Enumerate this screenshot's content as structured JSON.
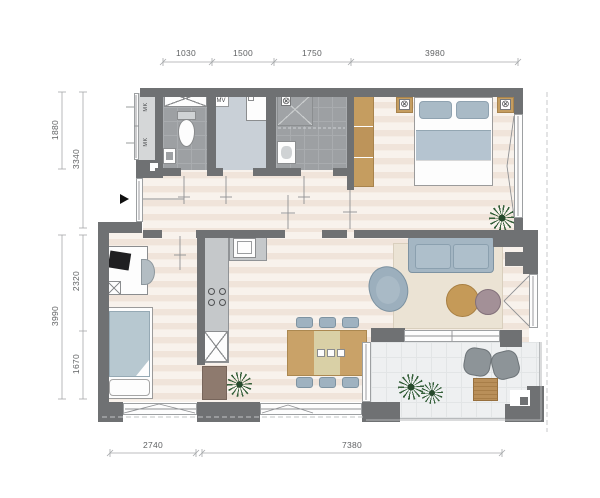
{
  "dimensions": {
    "top": [
      "1030",
      "1500",
      "1750",
      "3980"
    ],
    "left": [
      "1880",
      "3340",
      "3990",
      "2320",
      "1670"
    ],
    "bottom": [
      "2740",
      "7380"
    ]
  },
  "labels": {
    "mk1": "MK",
    "mk2": "MK",
    "mv": "MV"
  },
  "symbols": {
    "lamp_left": "⊗",
    "lamp_right": "⊗",
    "drain": "⊗"
  },
  "colors": {
    "wall": "#6f7173",
    "wood_furniture": "#c59d60",
    "floor_light": "#f8f2ec",
    "floor_stripe": "#f0e4da",
    "wet_room_floor": "#9da0a3",
    "tech_room_floor": "#c9d0d7",
    "upholstery": "#a4b6c3",
    "rug": "#ebe3d4",
    "plant": "#35603a",
    "balcony_floor": "#eef0f1"
  }
}
